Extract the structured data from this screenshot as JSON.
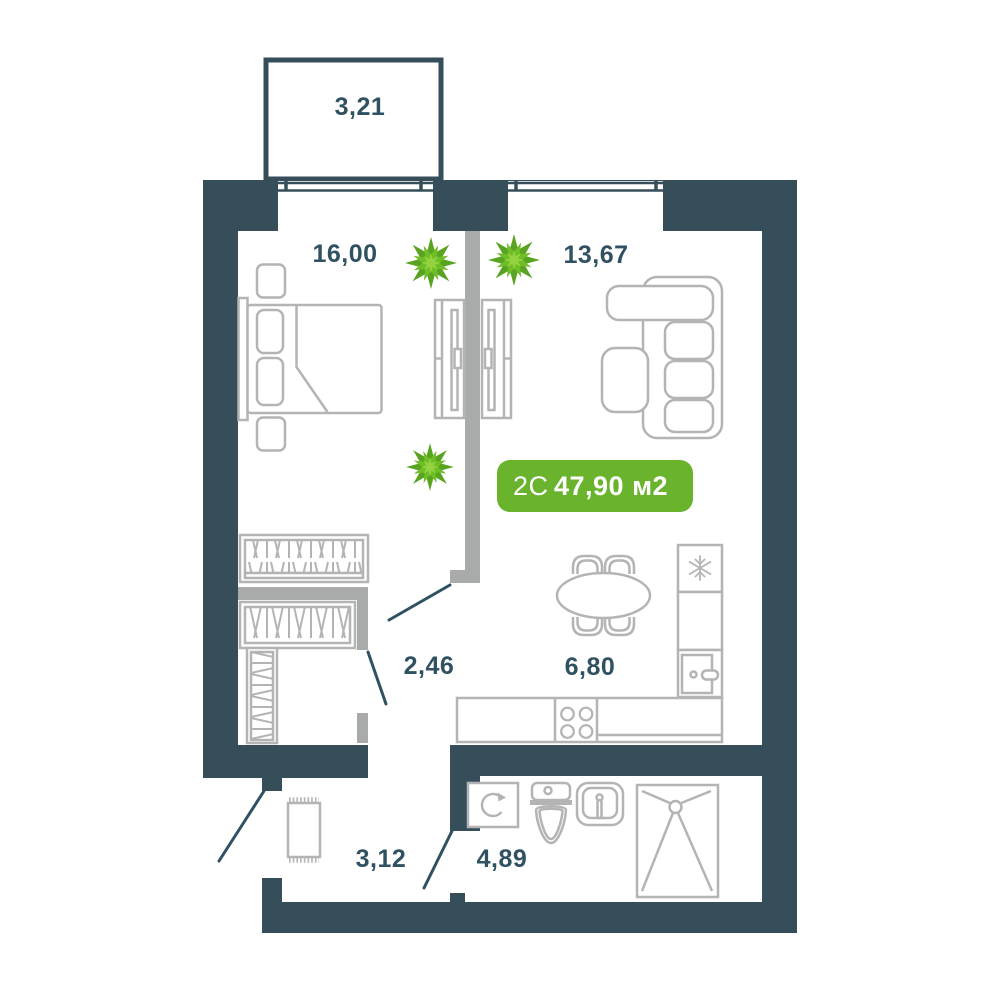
{
  "plan": {
    "badge": {
      "unit_type": "2С",
      "area_label": "47,90 м2"
    },
    "rooms": [
      {
        "name": "balcony",
        "area": "3,21"
      },
      {
        "name": "bedroom",
        "area": "16,00"
      },
      {
        "name": "living-room",
        "area": "13,67"
      },
      {
        "name": "corridor",
        "area": "2,46"
      },
      {
        "name": "kitchen",
        "area": "6,80"
      },
      {
        "name": "hallway",
        "area": "3,12"
      },
      {
        "name": "bathroom",
        "area": "4,89"
      }
    ],
    "colors": {
      "wall": "#364e59",
      "accent_green": "#69b42c",
      "furniture": "#b4b4b4",
      "partition_gray": "#a9abaa",
      "label_text": "#2f5162",
      "plant_dark": "#58a31f",
      "plant_mid": "#6fbe28",
      "plant_light": "#92d33f"
    },
    "icons": [
      "plant-icon",
      "snowflake-icon",
      "washer-rotation-icon",
      "stove-burner-icon",
      "shower-drain-icon"
    ]
  }
}
